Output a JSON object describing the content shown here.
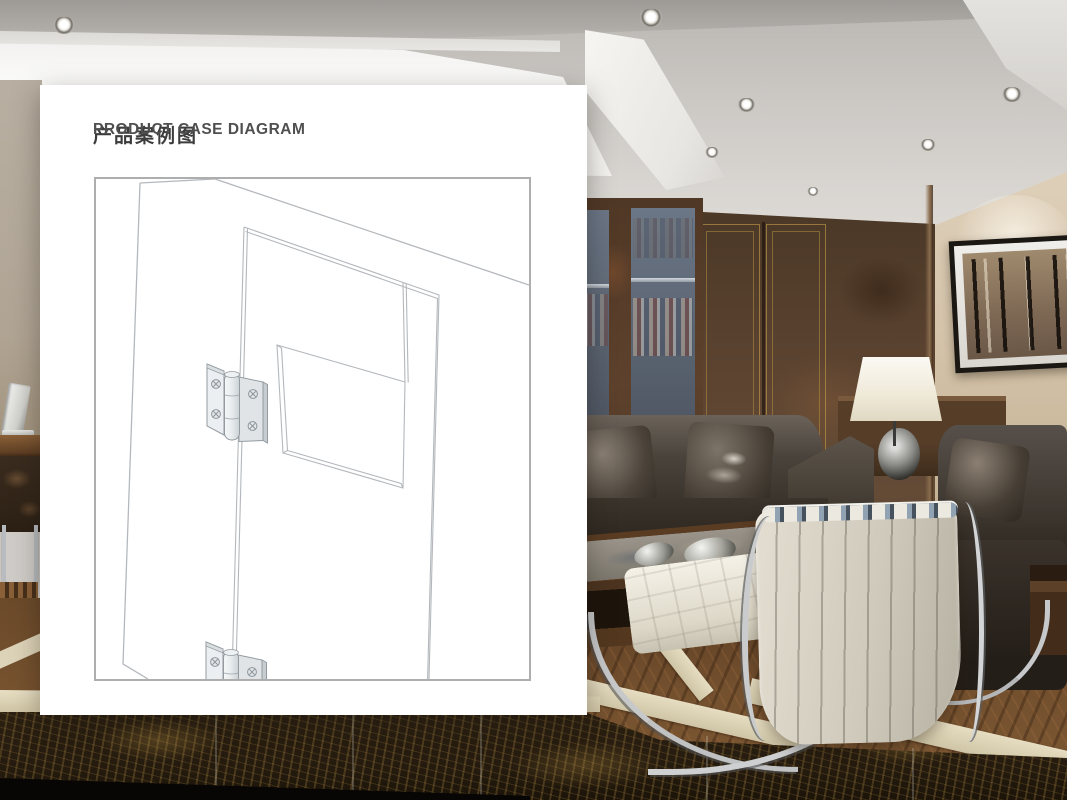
{
  "header": {
    "title_zh": "产品案例图",
    "title_en": "PRODUCT CASE DIAGRAM"
  },
  "diagram": {
    "subject": "door-panel-with-two-butt-hinges",
    "hinge_count": 2,
    "screws_per_hinge": 4
  },
  "palette": {
    "card-bg": "#ffffff",
    "title-color": "#3c3c3c",
    "title-en-color": "#4f4f4f",
    "box-border": "#aeaeae",
    "line": "#b4b8bc",
    "hinge-outline": "#939ba1"
  }
}
